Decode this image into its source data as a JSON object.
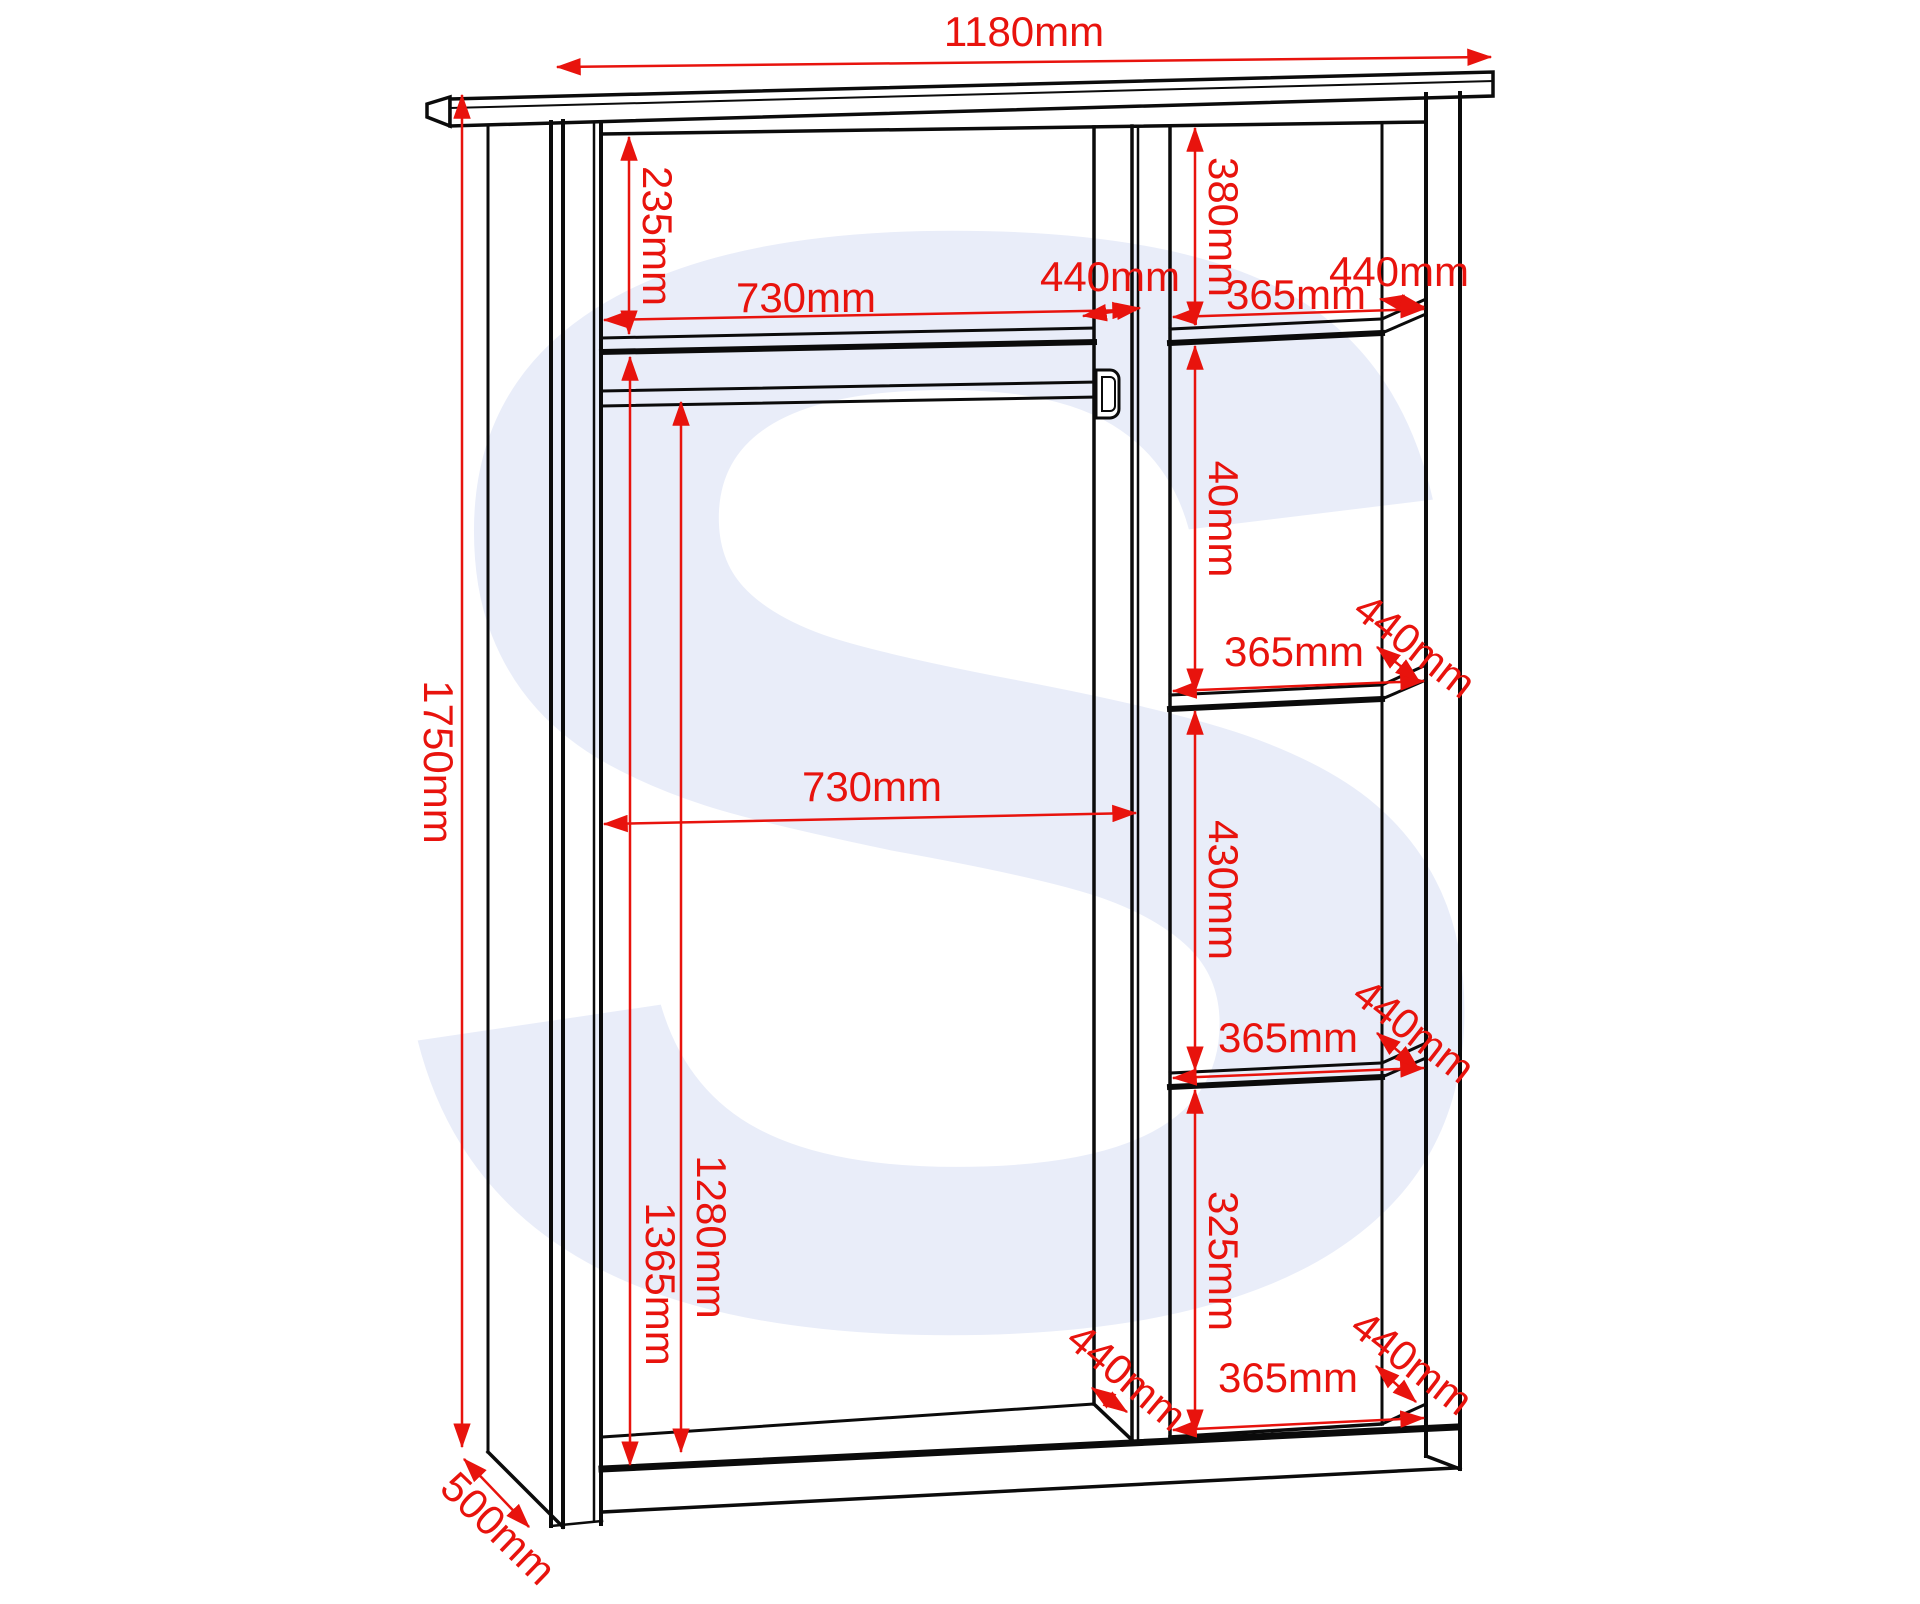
{
  "diagram": {
    "watermark_letter": "S",
    "colors": {
      "outline": "#0b0b0b",
      "dimension_red": "#e8130d",
      "watermark_blue": "#e9edf9",
      "background": "#ffffff"
    },
    "overall": {
      "width_label": "1180mm",
      "height_label": "1750mm",
      "depth_label": "500mm"
    },
    "left_compartment": {
      "top_clearance_label": "235mm",
      "top_shelf_width_label": "730mm",
      "divider_depth_label": "440mm",
      "interior_width_label": "730mm",
      "shelf_to_base_height_label": "1365mm",
      "rail_to_base_height_label": "1280mm",
      "base_depth_label": "440mm"
    },
    "right_column": {
      "sections": [
        {
          "height_label": "380mm",
          "width_label": "365mm",
          "depth_label": "440mm"
        },
        {
          "height_label": "40mm",
          "width_label": "365mm",
          "depth_label": "440mm"
        },
        {
          "height_label": "430mm",
          "width_label": "365mm",
          "depth_label": "440mm"
        },
        {
          "height_label": "325mm",
          "width_label": "365mm",
          "depth_label": "440mm"
        }
      ]
    }
  }
}
